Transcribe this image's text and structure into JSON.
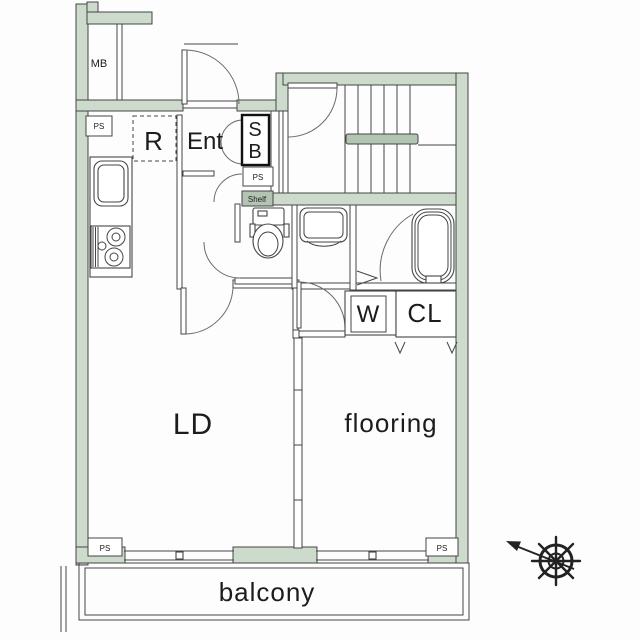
{
  "colors": {
    "wall": "#ccdbcc",
    "wall_dark": "#b2c4b2",
    "line": "#454545",
    "text": "#1c1c1c",
    "bg": "#fdfdfd"
  },
  "labels": {
    "meter_box": "MB",
    "pipe_space_top": "PS",
    "refrigerator": "R",
    "entrance": "Ent",
    "shoe_box_s": "S",
    "shoe_box_b": "B",
    "pipe_space_mid": "PS",
    "shelf": "Shelf",
    "washing_machine": "W",
    "closet": "CL",
    "living_dining": "LD",
    "flooring_room": "flooring",
    "balcony": "balcony",
    "pipe_space_bottom_left": "PS",
    "pipe_space_bottom_right": "PS"
  }
}
